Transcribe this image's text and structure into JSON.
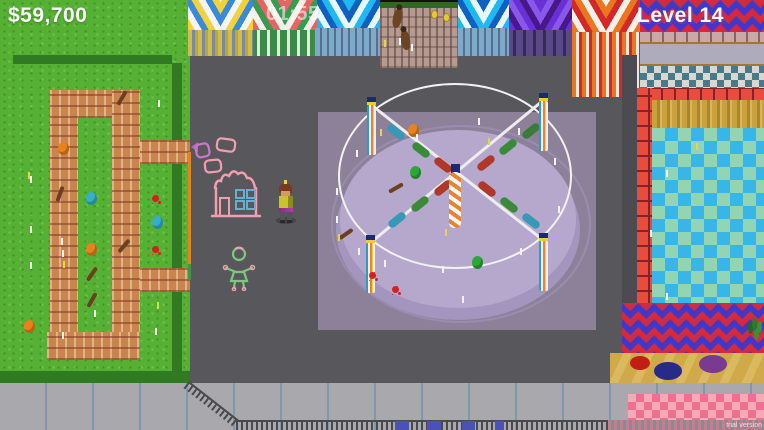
{
  "hud": {
    "money": "$59,700",
    "timer": "01:55",
    "level_label": "Level 14",
    "watermark": "trial version"
  },
  "palette": {
    "grass": "#56b033",
    "hedge": "#2f7a22",
    "plaza_gray": "#58575c",
    "carousel_mat": "#8d8199",
    "carousel_disc": "#b6a8cd",
    "pool_blue": "#38b6ea",
    "pool_mint": "#93d4b3",
    "pool_border_red": "#e84c3d",
    "maze_brick": "#c9854f",
    "tent_red": "#d42a3c",
    "tent_blue": "#4038c8",
    "chalk_pink": "#ef9fae",
    "chalk_green": "#7ec87e",
    "chalk_window_blue": "#69aecd"
  },
  "scene": {
    "items": [
      {
        "t": "balloon",
        "x": 58,
        "y": 142,
        "c": "#e8821e"
      },
      {
        "t": "balloon",
        "x": 86,
        "y": 192,
        "c": "#35aec8"
      },
      {
        "t": "balloon",
        "x": 86,
        "y": 243,
        "c": "#e8821e"
      },
      {
        "t": "balloon",
        "x": 24,
        "y": 320,
        "c": "#e8821e"
      },
      {
        "t": "balloon",
        "x": 152,
        "y": 216,
        "c": "#35aec8"
      },
      {
        "t": "splat",
        "x": 152,
        "y": 195,
        "c": "#d42020"
      },
      {
        "t": "splat",
        "x": 152,
        "y": 246,
        "c": "#d42020"
      },
      {
        "t": "stick",
        "x": 120,
        "y": 90,
        "r": 30
      },
      {
        "t": "stick",
        "x": 58,
        "y": 186,
        "r": 20
      },
      {
        "t": "stick",
        "x": 122,
        "y": 238,
        "r": 40
      },
      {
        "t": "stick",
        "x": 90,
        "y": 266,
        "r": 35
      },
      {
        "t": "stick",
        "x": 90,
        "y": 292,
        "r": 30
      },
      {
        "t": "tickw",
        "x": 30,
        "y": 176
      },
      {
        "t": "tickw",
        "x": 30,
        "y": 226
      },
      {
        "t": "tickw",
        "x": 30,
        "y": 262
      },
      {
        "t": "tickw",
        "x": 62,
        "y": 250
      },
      {
        "t": "tickw",
        "x": 94,
        "y": 310
      },
      {
        "t": "tickw",
        "x": 61,
        "y": 238
      },
      {
        "t": "tickw",
        "x": 62,
        "y": 332
      },
      {
        "t": "tickw",
        "x": 158,
        "y": 100
      },
      {
        "t": "tickw",
        "x": 155,
        "y": 328
      },
      {
        "t": "ticky",
        "x": 28,
        "y": 172
      },
      {
        "t": "ticky",
        "x": 63,
        "y": 261
      },
      {
        "t": "ticky",
        "x": 157,
        "y": 302
      },
      {
        "t": "balloon",
        "x": 408,
        "y": 124,
        "c": "#e8821e"
      },
      {
        "t": "balloon",
        "x": 410,
        "y": 166,
        "c": "#2ca83a"
      },
      {
        "t": "balloon",
        "x": 472,
        "y": 256,
        "c": "#2ca83a"
      },
      {
        "t": "splat",
        "x": 369,
        "y": 272,
        "c": "#d42020"
      },
      {
        "t": "splat",
        "x": 392,
        "y": 286,
        "c": "#d42020"
      },
      {
        "t": "stick",
        "x": 394,
        "y": 180,
        "r": 60
      },
      {
        "t": "stick",
        "x": 344,
        "y": 226,
        "r": 55
      },
      {
        "t": "tickw",
        "x": 356,
        "y": 150
      },
      {
        "t": "tickw",
        "x": 336,
        "y": 188
      },
      {
        "t": "tickw",
        "x": 336,
        "y": 216
      },
      {
        "t": "tickw",
        "x": 358,
        "y": 248
      },
      {
        "t": "tickw",
        "x": 384,
        "y": 260
      },
      {
        "t": "tickw",
        "x": 442,
        "y": 266
      },
      {
        "t": "tickw",
        "x": 520,
        "y": 248
      },
      {
        "t": "tickw",
        "x": 558,
        "y": 206
      },
      {
        "t": "tickw",
        "x": 554,
        "y": 158
      },
      {
        "t": "tickw",
        "x": 518,
        "y": 128
      },
      {
        "t": "tickw",
        "x": 478,
        "y": 118
      },
      {
        "t": "tickw",
        "x": 416,
        "y": 134
      },
      {
        "t": "tickw",
        "x": 462,
        "y": 296
      },
      {
        "t": "ticky",
        "x": 380,
        "y": 129
      },
      {
        "t": "ticky",
        "x": 488,
        "y": 138
      },
      {
        "t": "ticky",
        "x": 445,
        "y": 229
      },
      {
        "t": "ticky",
        "x": 338,
        "y": 234
      },
      {
        "t": "ticky",
        "x": 384,
        "y": 40
      },
      {
        "t": "tickw",
        "x": 399,
        "y": 38
      },
      {
        "t": "tickw",
        "x": 411,
        "y": 44
      },
      {
        "t": "coin",
        "x": 431,
        "y": 10
      },
      {
        "t": "coin",
        "x": 443,
        "y": 13
      },
      {
        "t": "tickw",
        "x": 666,
        "y": 170
      },
      {
        "t": "tickw",
        "x": 650,
        "y": 230
      },
      {
        "t": "tickw",
        "x": 666,
        "y": 293
      },
      {
        "t": "ticky",
        "x": 696,
        "y": 143
      }
    ]
  }
}
